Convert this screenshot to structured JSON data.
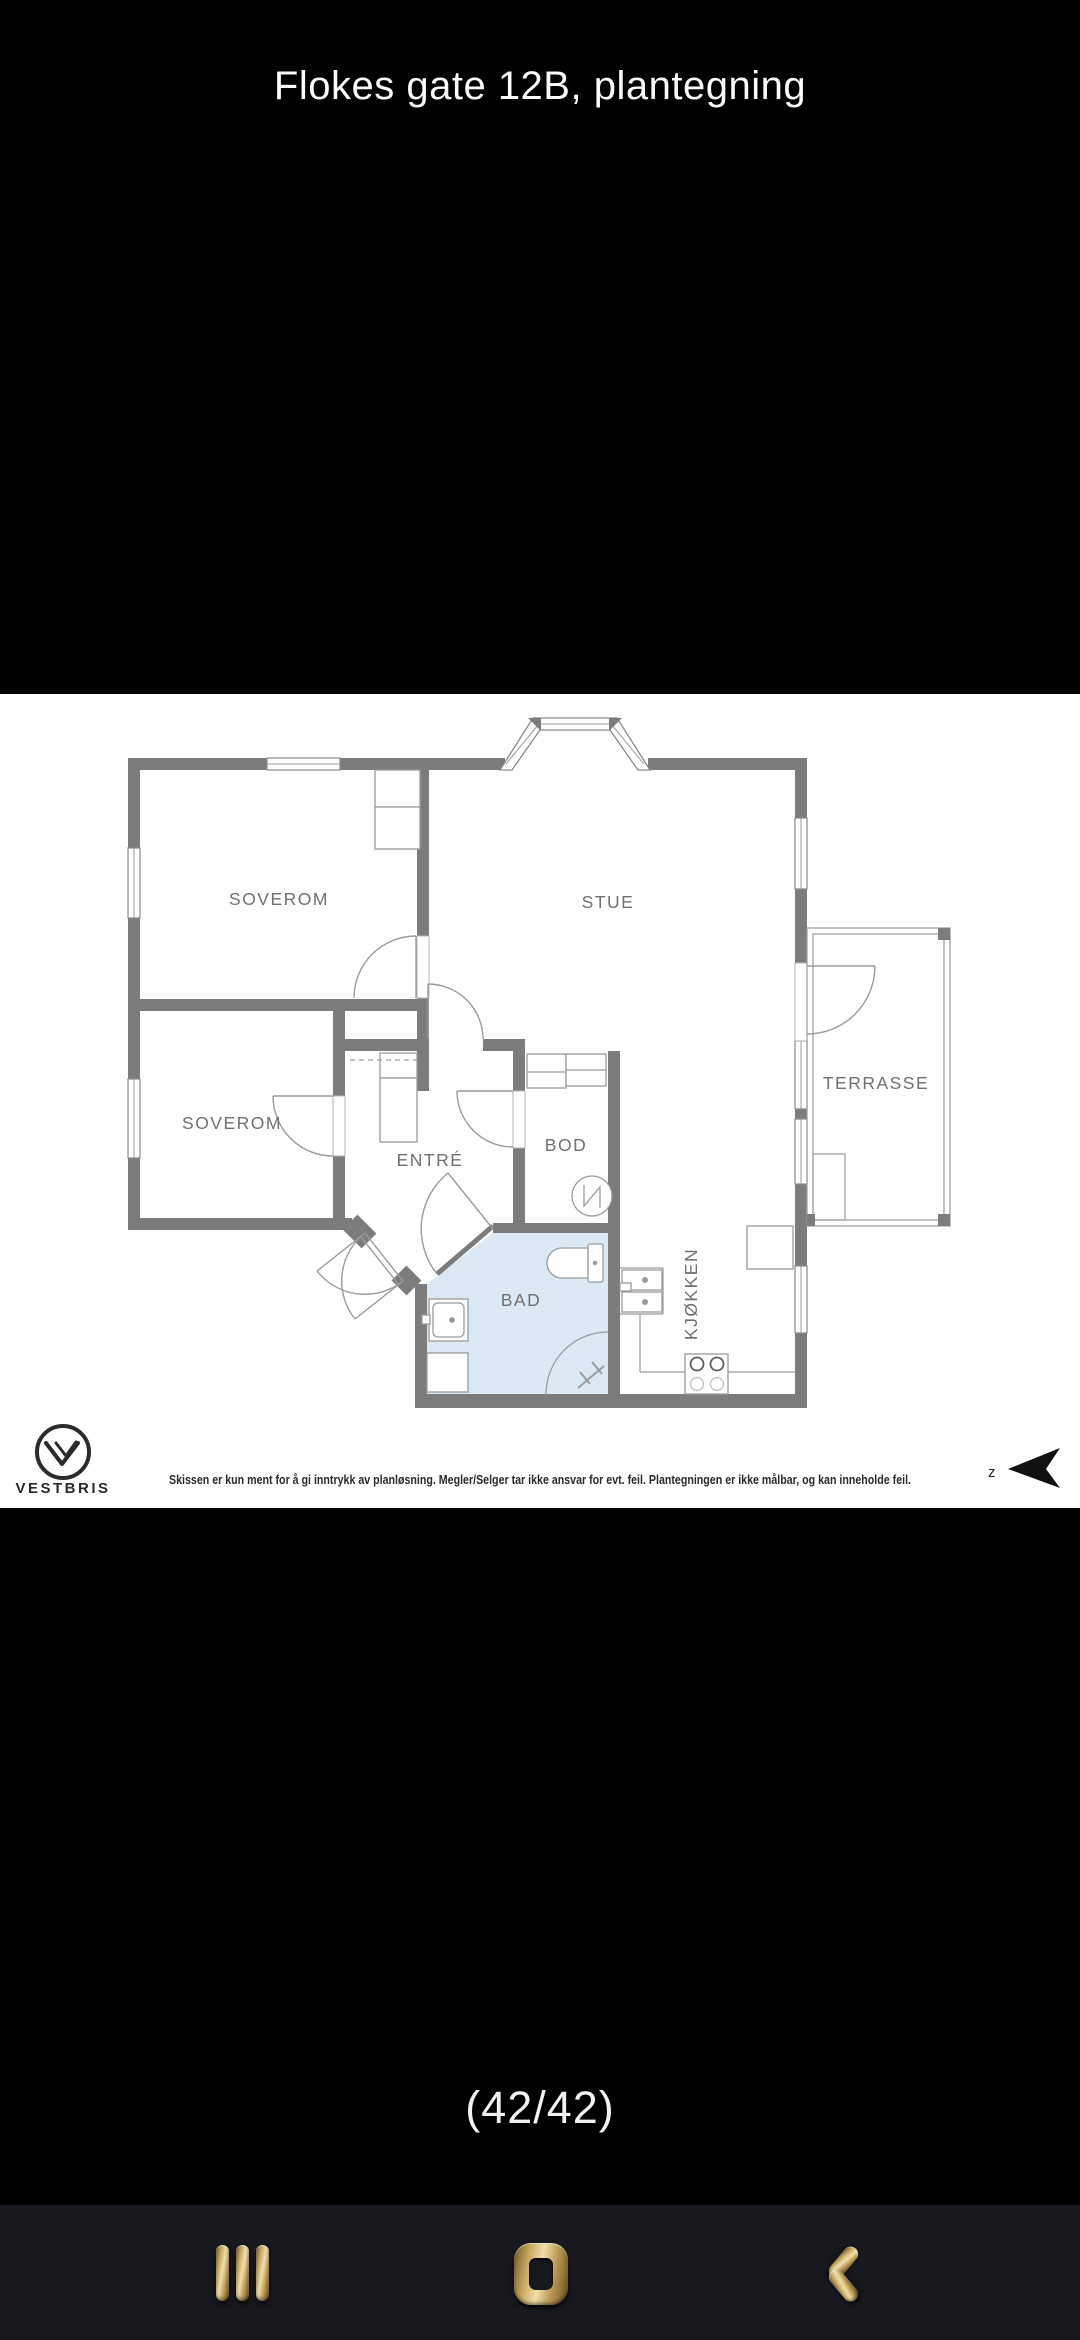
{
  "header": {
    "title": "Flokes gate 12B, plantegning"
  },
  "floorplan": {
    "labels": {
      "soverom1": "SOVEROM",
      "stue": "STUE",
      "soverom2": "SOVEROM",
      "entre": "ENTRÉ",
      "bod": "BOD",
      "bad": "BAD",
      "kjokken": "KJØKKEN",
      "terrasse": "TERRASSE"
    },
    "brand": "VESTBRIS",
    "disclaimer": "Skissen er kun ment for å gi inntrykk av planløsning. Megler/Selger tar ikke ansvar for evt. feil. Plantegningen er ikke målbar, og kan inneholde feil.",
    "compass_label": "z",
    "colors": {
      "wall": "#7c7c7c",
      "thin_line": "#9b9b9b",
      "label_text": "#707070",
      "bathroom_fill": "#dbe9f4",
      "panel_bg": "#ffffff"
    }
  },
  "pager": {
    "label": "(42/42)"
  },
  "navbar": {
    "background": "#18181f",
    "accent_gold": "#c9a85f",
    "buttons": [
      {
        "name": "recents",
        "icon": "three-bars-icon"
      },
      {
        "name": "home",
        "icon": "rounded-square-icon"
      },
      {
        "name": "back",
        "icon": "chevron-left-icon"
      }
    ]
  }
}
